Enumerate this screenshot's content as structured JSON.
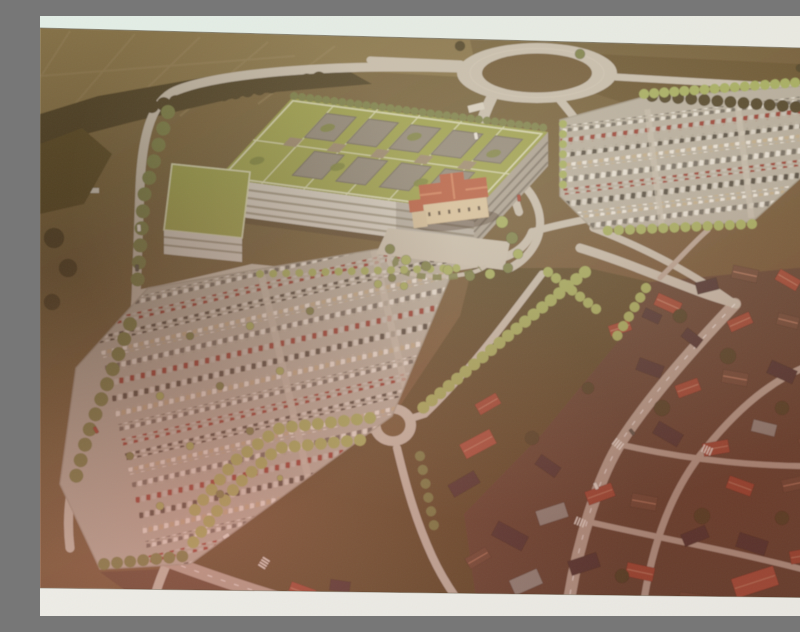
{
  "meta": {
    "description": "Photograph of an aerial architectural rendering: a large hospital campus with green roofs and courtyards, a historic villa with orange roof, two big tree-lined parking lots full of cars, a large road roundabout at top, a small roundabout below, farmland at upper left and a dense town of red-roofed houses at lower right. Light paper bands are visible at the top and bottom of the photographed print."
  },
  "palette": {
    "band_top_a": "#e2eee6",
    "band_top_b": "#eae9e1",
    "band_bottom_a": "#edece6",
    "band_bottom_b": "#e9e7e1",
    "terrain_a": "#7d6c44",
    "terrain_b": "#6e5e3a",
    "terrain_c": "#6f5737",
    "terrain_d": "#6a4833",
    "field_light": "#85744a",
    "field_line": "#93825a",
    "field_ne": "#64512f",
    "tree_dark": "#4a4026",
    "tree_mid": "#77804a",
    "tree_light": "#a3b060",
    "tree_mass": "#554928",
    "road": "#c6c0b2",
    "road_warm": "#b7a698",
    "ring_center": "#6b5735",
    "asphalt": "#b5b0a3",
    "lot_edge": "#a39e90",
    "roof_green": "#9aa24e",
    "roof_path": "#d8dcb6",
    "roof_green_dark": "#79843f",
    "courtyard": "#8d887c",
    "courtyard_edge": "#6e6960",
    "penthouse": "#998a72",
    "facade": "#d2cfc6",
    "facade_shadow": "#a8a296",
    "window_band": "#97917f",
    "facade_dark": "#7b766c",
    "villa_wall": "#d9c6a2",
    "villa_annex": "#d2bf9c",
    "villa_roof": "#b65c42",
    "villa_roof_hi": "#d1815f",
    "villa_window": "#5f5142",
    "plaza": "#c9c3b4",
    "meadow": "#584a2b",
    "town_ground": "#5d4233",
    "roof_red": "#9e4636",
    "roof_red2": "#a84f3c",
    "roof_brown": "#6a4a38",
    "roof_dark": "#473230",
    "roof_gray": "#8f8c86",
    "ridge": "#c98a70",
    "car_white": "#e9e7df",
    "car_dark": "#57544c",
    "car_red": "#a23f31",
    "entrance": "#d8d4c8"
  },
  "scene": {
    "roads": [
      {
        "d": "M 419,52 C 300,48 180,56 135,75 C 112,85 102,120 100,170 C 98,230 97,255 96,282 C 94,330 70,380 42,440 C 30,465 26,500 30,532",
        "w": 9,
        "c": "road"
      },
      {
        "d": "M 576,61 C 650,66 725,70 800,74",
        "w": 7,
        "c": "road"
      },
      {
        "d": "M 330,44 L 421,48",
        "w": 7,
        "c": "road"
      },
      {
        "d": "M 452,81 C 445,95 441,106 439,118",
        "w": 11,
        "c": "road"
      },
      {
        "d": "M 520,84 C 529,95 537,104 543,116",
        "w": 8,
        "c": "road"
      },
      {
        "d": "M 472,118 C 470,148 470,172 479,196",
        "w": 8,
        "c": "road"
      },
      {
        "d": "M 97,278 C 130,272 170,262 212,252 C 300,262 380,258 446,246 C 470,242 486,232 492,216",
        "w": 8,
        "c": "road"
      },
      {
        "d": "M 470,160 C 498,175 506,205 496,226 C 489,240 479,248 468,253",
        "w": 8,
        "c": "road"
      },
      {
        "d": "M 492,216 C 512,210 532,206 553,202",
        "w": 7,
        "c": "road"
      },
      {
        "d": "M 502,258 C 470,300 430,355 385,398",
        "w": 7,
        "c": "road"
      },
      {
        "d": "M 385,398 L 341,412",
        "w": 7,
        "c": "road"
      },
      {
        "d": "M 341,412 C 290,415 250,420 215,440 C 180,462 150,500 128,545 C 122,558 116,574 112,590",
        "w": 9,
        "c": "road"
      },
      {
        "d": "M 357,432 C 366,470 376,505 392,540 C 402,562 414,580 428,598",
        "w": 8,
        "c": "road"
      },
      {
        "d": "M 128,545 C 185,566 245,586 305,600",
        "w": 13,
        "c": "road_warm"
      },
      {
        "d": "M 695,288 C 655,330 612,378 582,424 C 560,458 537,525 527,598",
        "w": 12,
        "c": "road_warm"
      },
      {
        "d": "M 800,340 C 742,352 700,390 666,432 C 636,468 612,520 602,598",
        "w": 7,
        "c": "road_warm"
      },
      {
        "d": "M 578,428 C 648,444 724,452 798,450",
        "w": 6,
        "c": "road_warm"
      },
      {
        "d": "M 545,505 C 618,522 700,536 788,560",
        "w": 6,
        "c": "road_warm"
      },
      {
        "d": "M 540,232 C 580,244 622,262 660,276 C 676,282 688,285 696,288",
        "w": 9,
        "c": "road"
      },
      {
        "d": "M 553,212 C 600,230 650,255 695,288",
        "w": 7,
        "c": "road"
      },
      {
        "d": "M 620,262 C 642,240 656,224 668,214",
        "w": 5,
        "c": "road_warm"
      }
    ],
    "road_dashes": [
      {
        "d": "M 695,288 C 655,330 612,378 582,424 C 560,458 537,525 527,598"
      },
      {
        "d": "M 128,545 C 185,566 245,586 305,600"
      }
    ],
    "tree_lines": [
      {
        "pts": "254,80 506,112",
        "c": "tree_mid",
        "r": 4,
        "sp": 8
      },
      {
        "pts": "64,98 282,62",
        "c": "tree_dark",
        "r": 7,
        "sp": 12
      },
      {
        "pts": "612,80 795,94",
        "c": "tree_dark",
        "r": 6,
        "sp": 13
      },
      {
        "pts": "604,78 764,66",
        "c": "tree_light",
        "r": 5,
        "sp": 10
      },
      {
        "pts": "768,76 780,146",
        "c": "tree_light",
        "r": 5,
        "sp": 10
      },
      {
        "pts": "712,208 560,215",
        "c": "tree_light",
        "r": 5,
        "sp": 11
      },
      {
        "pts": "523,108 523,178",
        "c": "tree_light",
        "r": 4,
        "sp": 10
      },
      {
        "pts": "545,256 458,328 376,398",
        "c": "tree_light",
        "r": 6,
        "sp": 11
      },
      {
        "pts": "508,256 560,296",
        "c": "tree_light",
        "r": 5,
        "sp": 10
      },
      {
        "pts": "330,402 240,412 196,444 150,500",
        "c": "tree_light",
        "r": 6,
        "sp": 13
      },
      {
        "pts": "320,424 238,432 196,470 152,528",
        "c": "tree_light",
        "r": 6,
        "sp": 13
      },
      {
        "pts": "128,96 104,180 97,272",
        "c": "tree_mid",
        "r": 7,
        "sp": 17
      },
      {
        "pts": "90,308 48,418 34,468",
        "c": "tree_mid",
        "r": 7,
        "sp": 16
      },
      {
        "pts": "64,548 146,540",
        "c": "tree_mid",
        "r": 6,
        "sp": 13
      },
      {
        "pts": "220,258 420,252",
        "c": "tree_light",
        "r": 4,
        "sp": 13
      },
      {
        "pts": "606,272 576,322",
        "c": "tree_light",
        "r": 5,
        "sp": 11
      },
      {
        "pts": "380,440 396,520",
        "c": "tree_mid",
        "r": 5,
        "sp": 14
      }
    ],
    "trees": [
      [
        462,
        206,
        6,
        "tree_light"
      ],
      [
        472,
        222,
        6,
        "tree_mid"
      ],
      [
        478,
        238,
        5,
        "tree_light"
      ],
      [
        468,
        252,
        5,
        "tree_mid"
      ],
      [
        450,
        258,
        5,
        "tree_light"
      ],
      [
        430,
        260,
        5,
        "tree_mid"
      ],
      [
        408,
        254,
        5,
        "tree_light"
      ],
      [
        386,
        250,
        5,
        "tree_mid"
      ],
      [
        366,
        244,
        5,
        "tree_light"
      ],
      [
        350,
        233,
        5,
        "tree_mid"
      ],
      [
        352,
        262,
        4,
        "tree_mid"
      ],
      [
        364,
        270,
        4,
        "tree_light"
      ],
      [
        338,
        268,
        4,
        "tree_light"
      ],
      [
        150,
        320,
        4,
        "tree_mid"
      ],
      [
        210,
        310,
        4,
        "tree_light"
      ],
      [
        270,
        295,
        4,
        "tree_mid"
      ],
      [
        120,
        380,
        4,
        "tree_light"
      ],
      [
        180,
        370,
        4,
        "tree_mid"
      ],
      [
        240,
        355,
        4,
        "tree_light"
      ],
      [
        90,
        440,
        4,
        "tree_mid"
      ],
      [
        150,
        430,
        4,
        "tree_light"
      ],
      [
        210,
        415,
        4,
        "tree_mid"
      ],
      [
        120,
        490,
        4,
        "tree_light"
      ],
      [
        180,
        478,
        4,
        "tree_mid"
      ],
      [
        240,
        462,
        3,
        "tree_light"
      ],
      [
        640,
        300,
        7,
        "tree_dark"
      ],
      [
        688,
        340,
        8,
        "tree_dark"
      ],
      [
        742,
        392,
        7,
        "tree_dark"
      ],
      [
        622,
        392,
        8,
        "tree_dark"
      ],
      [
        662,
        500,
        8,
        "tree_dark"
      ],
      [
        742,
        502,
        7,
        "tree_dark"
      ],
      [
        582,
        560,
        7,
        "tree_dark"
      ],
      [
        492,
        422,
        7,
        "tree_dark"
      ],
      [
        548,
        372,
        6,
        "tree_dark"
      ],
      [
        14,
        222,
        10,
        "tree_dark"
      ],
      [
        28,
        252,
        9,
        "tree_dark"
      ],
      [
        12,
        286,
        8,
        "tree_dark"
      ],
      [
        540,
        38,
        5,
        "tree_mid"
      ],
      [
        420,
        30,
        5,
        "tree_dark"
      ],
      [
        788,
        58,
        5,
        "tree_dark"
      ],
      [
        760,
        52,
        4,
        "tree_dark"
      ]
    ],
    "houses": [
      [
        628,
        288,
        26,
        13,
        24,
        "roof_red"
      ],
      [
        667,
        270,
        22,
        12,
        -14,
        "roof_dark"
      ],
      [
        705,
        258,
        26,
        13,
        12,
        "roof_brown"
      ],
      [
        748,
        264,
        24,
        12,
        30,
        "roof_red"
      ],
      [
        783,
        254,
        20,
        11,
        -10,
        "roof_dark"
      ],
      [
        700,
        306,
        24,
        12,
        -24,
        "roof_red"
      ],
      [
        748,
        305,
        22,
        12,
        14,
        "roof_brown"
      ],
      [
        786,
        300,
        18,
        10,
        -8,
        "roof_gray"
      ],
      [
        652,
        322,
        20,
        11,
        38,
        "roof_dark"
      ],
      [
        610,
        352,
        26,
        13,
        20,
        "roof_dark"
      ],
      [
        648,
        372,
        24,
        13,
        -20,
        "roof_red"
      ],
      [
        695,
        362,
        26,
        13,
        10,
        "roof_brown"
      ],
      [
        742,
        356,
        28,
        14,
        24,
        "roof_dark"
      ],
      [
        784,
        372,
        22,
        12,
        -14,
        "roof_red"
      ],
      [
        628,
        418,
        28,
        14,
        30,
        "roof_dark"
      ],
      [
        676,
        432,
        26,
        13,
        -10,
        "roof_red"
      ],
      [
        724,
        412,
        24,
        12,
        14,
        "roof_gray"
      ],
      [
        772,
        424,
        26,
        13,
        -24,
        "roof_brown"
      ],
      [
        700,
        470,
        26,
        13,
        20,
        "roof_red"
      ],
      [
        754,
        468,
        24,
        13,
        -12,
        "roof_brown"
      ],
      [
        438,
        428,
        34,
        16,
        -28,
        "roof_red2"
      ],
      [
        424,
        468,
        30,
        14,
        -30,
        "roof_dark"
      ],
      [
        448,
        388,
        24,
        12,
        -30,
        "roof_red"
      ],
      [
        470,
        520,
        34,
        16,
        28,
        "roof_dark"
      ],
      [
        512,
        498,
        30,
        15,
        -18,
        "roof_gray"
      ],
      [
        560,
        478,
        28,
        14,
        -20,
        "roof_red"
      ],
      [
        604,
        486,
        26,
        14,
        10,
        "roof_brown"
      ],
      [
        655,
        520,
        26,
        13,
        -22,
        "roof_dark"
      ],
      [
        712,
        528,
        30,
        15,
        18,
        "roof_dark"
      ],
      [
        762,
        540,
        24,
        13,
        -10,
        "roof_red"
      ],
      [
        600,
        556,
        28,
        14,
        12,
        "roof_red"
      ],
      [
        544,
        548,
        30,
        15,
        -18,
        "roof_dark"
      ],
      [
        715,
        566,
        44,
        20,
        -18,
        "roof_red2"
      ],
      [
        652,
        584,
        26,
        13,
        8,
        "roof_brown"
      ],
      [
        262,
        576,
        26,
        13,
        20,
        "roof_red"
      ],
      [
        330,
        586,
        24,
        12,
        -14,
        "roof_brown"
      ],
      [
        300,
        570,
        20,
        11,
        8,
        "roof_dark"
      ],
      [
        486,
        566,
        30,
        16,
        -24,
        "roof_gray"
      ],
      [
        438,
        542,
        24,
        12,
        -30,
        "roof_brown"
      ],
      [
        508,
        450,
        24,
        12,
        35,
        "roof_dark"
      ],
      [
        580,
        312,
        22,
        11,
        -18,
        "roof_red"
      ],
      [
        612,
        300,
        18,
        10,
        25,
        "roof_dark"
      ]
    ],
    "crosswalks": [
      [
        578,
        428,
        38
      ],
      [
        540,
        506,
        22
      ],
      [
        224,
        547,
        -58
      ],
      [
        667,
        434,
        24
      ]
    ],
    "road_cars": [
      [
        99,
        212,
        86,
        "car_white"
      ],
      [
        97,
        252,
        88,
        "car_dark"
      ],
      [
        56,
        414,
        62,
        "car_red"
      ],
      [
        186,
        520,
        -32,
        "car_white"
      ],
      [
        246,
        578,
        -28,
        "car_white"
      ],
      [
        592,
        416,
        52,
        "car_dark"
      ],
      [
        556,
        470,
        66,
        "car_white"
      ],
      [
        479,
        182,
        84,
        "car_red"
      ],
      [
        436,
        120,
        80,
        "car_white"
      ]
    ],
    "parking": {
      "west": {
        "clip": "clip-west",
        "pivot": [
          108,
          272
        ],
        "angle": -13,
        "x0": -60,
        "y0": 6,
        "len": 430,
        "gap": 15,
        "rows": 19,
        "h": 7,
        "aisles": [
          {
            "x": 110,
            "w": 7
          },
          {
            "x": 225,
            "w": 7
          }
        ]
      },
      "east": {
        "clip": "clip-east",
        "pivot": [
          520,
          104
        ],
        "angle": -7,
        "x0": -6,
        "y0": 6,
        "len": 270,
        "gap": 12.5,
        "rows": 9,
        "h": 6.5,
        "aisles": [
          {
            "x": 85,
            "w": 6
          },
          {
            "x": 175,
            "w": 6
          }
        ]
      }
    }
  }
}
